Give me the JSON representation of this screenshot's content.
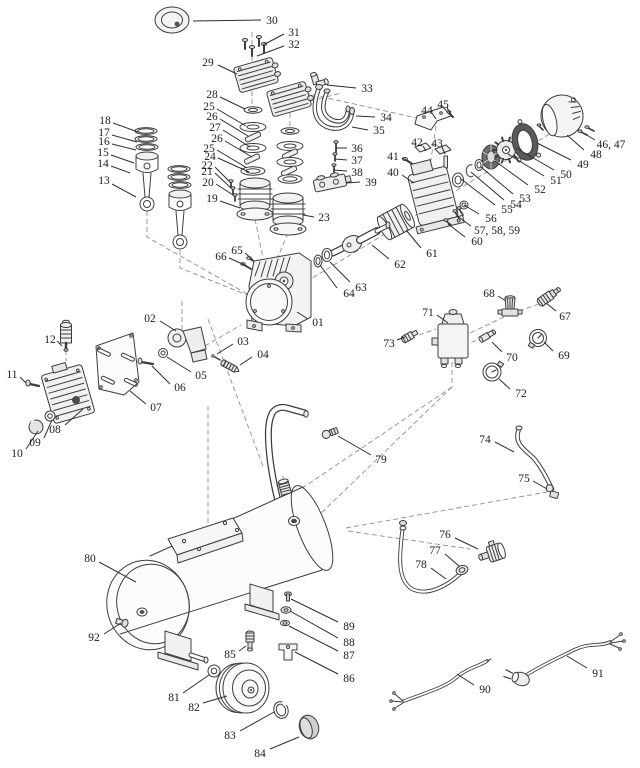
{
  "meta": {
    "figure_type": "exploded-parts-diagram",
    "subject": "air-compressor",
    "canvas": {
      "width": 640,
      "height": 768
    },
    "colors": {
      "background": "#ffffff",
      "ink": "#3d3d3d",
      "label": "#1c1c1c",
      "dashed": "#8f8f8f"
    }
  },
  "callouts": [
    {
      "label": "30",
      "x": 272,
      "y": 20,
      "leader": [
        261,
        20,
        193,
        21
      ]
    },
    {
      "label": "31",
      "x": 294,
      "y": 32,
      "leader": [
        284,
        34,
        263,
        45
      ]
    },
    {
      "label": "32",
      "x": 294,
      "y": 44,
      "leader": [
        284,
        46,
        257,
        56
      ]
    },
    {
      "label": "29",
      "x": 208,
      "y": 62,
      "leader": [
        218,
        65,
        237,
        74
      ]
    },
    {
      "label": "33",
      "x": 367,
      "y": 88,
      "leader": [
        356,
        88,
        327,
        85
      ]
    },
    {
      "label": "34",
      "x": 386,
      "y": 117,
      "leader": [
        375,
        117,
        356,
        116
      ]
    },
    {
      "label": "35",
      "x": 379,
      "y": 130,
      "leader": [
        368,
        130,
        352,
        127
      ]
    },
    {
      "label": "28",
      "x": 212,
      "y": 94,
      "leader": [
        220,
        97,
        245,
        109
      ]
    },
    {
      "label": "25",
      "x": 209,
      "y": 106,
      "leader": [
        217,
        109,
        246,
        126
      ]
    },
    {
      "label": "26",
      "x": 212,
      "y": 116,
      "leader": [
        220,
        119,
        248,
        136
      ]
    },
    {
      "label": "27",
      "x": 215,
      "y": 127,
      "leader": [
        223,
        130,
        250,
        147
      ]
    },
    {
      "label": "26",
      "x": 217,
      "y": 138,
      "leader": [
        225,
        141,
        252,
        157
      ]
    },
    {
      "label": "25",
      "x": 209,
      "y": 148,
      "leader": [
        217,
        150,
        247,
        168
      ]
    },
    {
      "label": "24",
      "x": 210,
      "y": 156,
      "leader": [
        218,
        158,
        249,
        172
      ]
    },
    {
      "label": "22",
      "x": 207,
      "y": 165,
      "leader": [
        215,
        167,
        229,
        181
      ]
    },
    {
      "label": "21",
      "x": 207,
      "y": 171,
      "leader": [
        215,
        173,
        231,
        188
      ]
    },
    {
      "label": "20",
      "x": 208,
      "y": 182,
      "leader": [
        216,
        184,
        233,
        195
      ]
    },
    {
      "label": "19",
      "x": 212,
      "y": 198,
      "leader": [
        220,
        201,
        240,
        208
      ]
    },
    {
      "label": "23",
      "x": 324,
      "y": 217,
      "leader": [
        314,
        217,
        303,
        215
      ]
    },
    {
      "label": "36",
      "x": 357,
      "y": 148,
      "leader": [
        347,
        148,
        336,
        148
      ]
    },
    {
      "label": "37",
      "x": 357,
      "y": 160,
      "leader": [
        347,
        160,
        335,
        159
      ]
    },
    {
      "label": "38",
      "x": 357,
      "y": 172,
      "leader": [
        347,
        171,
        334,
        170
      ]
    },
    {
      "label": "39",
      "x": 371,
      "y": 182,
      "leader": [
        360,
        182,
        347,
        183
      ]
    },
    {
      "label": "41",
      "x": 393,
      "y": 156,
      "leader": [
        402,
        158,
        410,
        162
      ]
    },
    {
      "label": "40",
      "x": 393,
      "y": 172,
      "leader": [
        402,
        175,
        414,
        183
      ]
    },
    {
      "label": "42",
      "x": 417,
      "y": 142,
      "leader": [
        423,
        146,
        426,
        151
      ]
    },
    {
      "label": "43",
      "x": 437,
      "y": 143,
      "leader": [
        442,
        147,
        445,
        154
      ]
    },
    {
      "label": "44",
      "x": 427,
      "y": 110,
      "leader": [
        432,
        113,
        436,
        119
      ]
    },
    {
      "label": "45",
      "x": 443,
      "y": 104,
      "leader": [
        447,
        107,
        450,
        114
      ]
    },
    {
      "label": "46, 47",
      "x": 611,
      "y": 144,
      "leader": [
        595,
        140,
        585,
        134
      ]
    },
    {
      "label": "48",
      "x": 596,
      "y": 154,
      "leader": [
        584,
        150,
        567,
        135
      ]
    },
    {
      "label": "49",
      "x": 583,
      "y": 164,
      "leader": [
        571,
        160,
        537,
        143
      ]
    },
    {
      "label": "50",
      "x": 566,
      "y": 174,
      "leader": [
        554,
        170,
        516,
        148
      ]
    },
    {
      "label": "51",
      "x": 556,
      "y": 180,
      "leader": [
        544,
        176,
        508,
        154
      ]
    },
    {
      "label": "52",
      "x": 540,
      "y": 189,
      "leader": [
        528,
        185,
        495,
        161
      ]
    },
    {
      "label": "53",
      "x": 525,
      "y": 198,
      "leader": [
        513,
        194,
        481,
        167
      ]
    },
    {
      "label": "54",
      "x": 516,
      "y": 204,
      "leader": [
        504,
        200,
        471,
        172
      ]
    },
    {
      "label": "55",
      "x": 507,
      "y": 209,
      "leader": [
        495,
        205,
        461,
        179
      ]
    },
    {
      "label": "56",
      "x": 491,
      "y": 218,
      "leader": [
        479,
        214,
        464,
        205
      ]
    },
    {
      "label": "57, 58, 59",
      "x": 497,
      "y": 230,
      "leader": [
        471,
        226,
        457,
        216
      ]
    },
    {
      "label": "60",
      "x": 477,
      "y": 241,
      "leader": [
        465,
        237,
        448,
        224
      ]
    },
    {
      "label": "61",
      "x": 432,
      "y": 253,
      "leader": [
        421,
        248,
        406,
        230
      ]
    },
    {
      "label": "62",
      "x": 400,
      "y": 264,
      "leader": [
        389,
        259,
        372,
        245
      ]
    },
    {
      "label": "63",
      "x": 361,
      "y": 287,
      "leader": [
        350,
        282,
        330,
        262
      ]
    },
    {
      "label": "64",
      "x": 349,
      "y": 293,
      "leader": [
        337,
        288,
        320,
        265
      ]
    },
    {
      "label": "65",
      "x": 237,
      "y": 250,
      "leader": [
        245,
        253,
        253,
        260
      ]
    },
    {
      "label": "66",
      "x": 221,
      "y": 256,
      "leader": [
        229,
        258,
        247,
        266
      ]
    },
    {
      "label": "01",
      "x": 318,
      "y": 322,
      "leader": [
        308,
        319,
        297,
        312
      ]
    },
    {
      "label": "02",
      "x": 150,
      "y": 318,
      "leader": [
        160,
        321,
        176,
        331
      ]
    },
    {
      "label": "03",
      "x": 243,
      "y": 341,
      "leader": [
        233,
        344,
        217,
        354
      ]
    },
    {
      "label": "04",
      "x": 263,
      "y": 354,
      "leader": [
        252,
        357,
        240,
        365
      ]
    },
    {
      "label": "05",
      "x": 201,
      "y": 375,
      "leader": [
        191,
        372,
        167,
        357
      ]
    },
    {
      "label": "06",
      "x": 180,
      "y": 387,
      "leader": [
        170,
        384,
        152,
        366
      ]
    },
    {
      "label": "07",
      "x": 156,
      "y": 407,
      "leader": [
        146,
        404,
        130,
        391
      ]
    },
    {
      "label": "08",
      "x": 55,
      "y": 429,
      "leader": [
        65,
        425,
        83,
        409
      ]
    },
    {
      "label": "09",
      "x": 35,
      "y": 442,
      "leader": [
        44,
        438,
        52,
        420
      ]
    },
    {
      "label": "10",
      "x": 17,
      "y": 453,
      "leader": [
        26,
        449,
        38,
        431
      ]
    },
    {
      "label": "11",
      "x": 12,
      "y": 374,
      "leader": [
        20,
        377,
        26,
        383
      ]
    },
    {
      "label": "12",
      "x": 50,
      "y": 339,
      "leader": [
        57,
        341,
        62,
        346
      ]
    },
    {
      "label": "13",
      "x": 104,
      "y": 180,
      "leader": [
        112,
        184,
        136,
        197
      ]
    },
    {
      "label": "14",
      "x": 103,
      "y": 163,
      "leader": [
        111,
        166,
        130,
        173
      ]
    },
    {
      "label": "15",
      "x": 103,
      "y": 152,
      "leader": [
        111,
        155,
        134,
        163
      ]
    },
    {
      "label": "16",
      "x": 104,
      "y": 141,
      "leader": [
        112,
        144,
        136,
        150
      ]
    },
    {
      "label": "17",
      "x": 104,
      "y": 132,
      "leader": [
        112,
        135,
        137,
        142
      ]
    },
    {
      "label": "18",
      "x": 105,
      "y": 120,
      "leader": [
        113,
        123,
        138,
        132
      ]
    },
    {
      "label": "67",
      "x": 565,
      "y": 316,
      "leader": [
        556,
        311,
        546,
        303
      ]
    },
    {
      "label": "68",
      "x": 489,
      "y": 293,
      "leader": [
        498,
        296,
        506,
        301
      ]
    },
    {
      "label": "69",
      "x": 564,
      "y": 355,
      "leader": [
        553,
        351,
        544,
        342
      ]
    },
    {
      "label": "70",
      "x": 512,
      "y": 357,
      "leader": [
        502,
        352,
        492,
        342
      ]
    },
    {
      "label": "71",
      "x": 428,
      "y": 312,
      "leader": [
        437,
        315,
        448,
        323
      ]
    },
    {
      "label": "72",
      "x": 521,
      "y": 393,
      "leader": [
        510,
        389,
        499,
        379
      ]
    },
    {
      "label": "73",
      "x": 389,
      "y": 343,
      "leader": [
        397,
        340,
        405,
        337
      ]
    },
    {
      "label": "74",
      "x": 485,
      "y": 439,
      "leader": [
        495,
        442,
        514,
        452
      ]
    },
    {
      "label": "75",
      "x": 524,
      "y": 478,
      "leader": [
        533,
        481,
        547,
        489
      ]
    },
    {
      "label": "79",
      "x": 381,
      "y": 459,
      "leader": [
        371,
        455,
        338,
        436
      ]
    },
    {
      "label": "76",
      "x": 445,
      "y": 534,
      "leader": [
        455,
        538,
        478,
        549
      ]
    },
    {
      "label": "77",
      "x": 435,
      "y": 550,
      "leader": [
        445,
        554,
        459,
        566
      ]
    },
    {
      "label": "78",
      "x": 421,
      "y": 564,
      "leader": [
        431,
        568,
        446,
        579
      ]
    },
    {
      "label": "80",
      "x": 90,
      "y": 558,
      "leader": [
        99,
        562,
        136,
        582
      ]
    },
    {
      "label": "92",
      "x": 94,
      "y": 637,
      "leader": [
        104,
        634,
        121,
        623
      ]
    },
    {
      "label": "85",
      "x": 230,
      "y": 654,
      "leader": [
        239,
        651,
        246,
        646
      ]
    },
    {
      "label": "81",
      "x": 174,
      "y": 697,
      "leader": [
        183,
        693,
        209,
        675
      ]
    },
    {
      "label": "82",
      "x": 194,
      "y": 707,
      "leader": [
        203,
        703,
        227,
        696
      ]
    },
    {
      "label": "83",
      "x": 230,
      "y": 735,
      "leader": [
        240,
        731,
        274,
        712
      ]
    },
    {
      "label": "84",
      "x": 260,
      "y": 753,
      "leader": [
        270,
        749,
        299,
        737
      ]
    },
    {
      "label": "86",
      "x": 349,
      "y": 678,
      "leader": [
        338,
        674,
        295,
        652
      ]
    },
    {
      "label": "87",
      "x": 349,
      "y": 655,
      "leader": [
        338,
        651,
        289,
        626
      ]
    },
    {
      "label": "88",
      "x": 349,
      "y": 642,
      "leader": [
        338,
        638,
        290,
        611
      ]
    },
    {
      "label": "89",
      "x": 349,
      "y": 626,
      "leader": [
        338,
        622,
        291,
        599
      ]
    },
    {
      "label": "90",
      "x": 485,
      "y": 689,
      "leader": [
        474,
        685,
        457,
        674
      ]
    },
    {
      "label": "91",
      "x": 598,
      "y": 673,
      "leader": [
        587,
        668,
        567,
        656
      ]
    }
  ]
}
